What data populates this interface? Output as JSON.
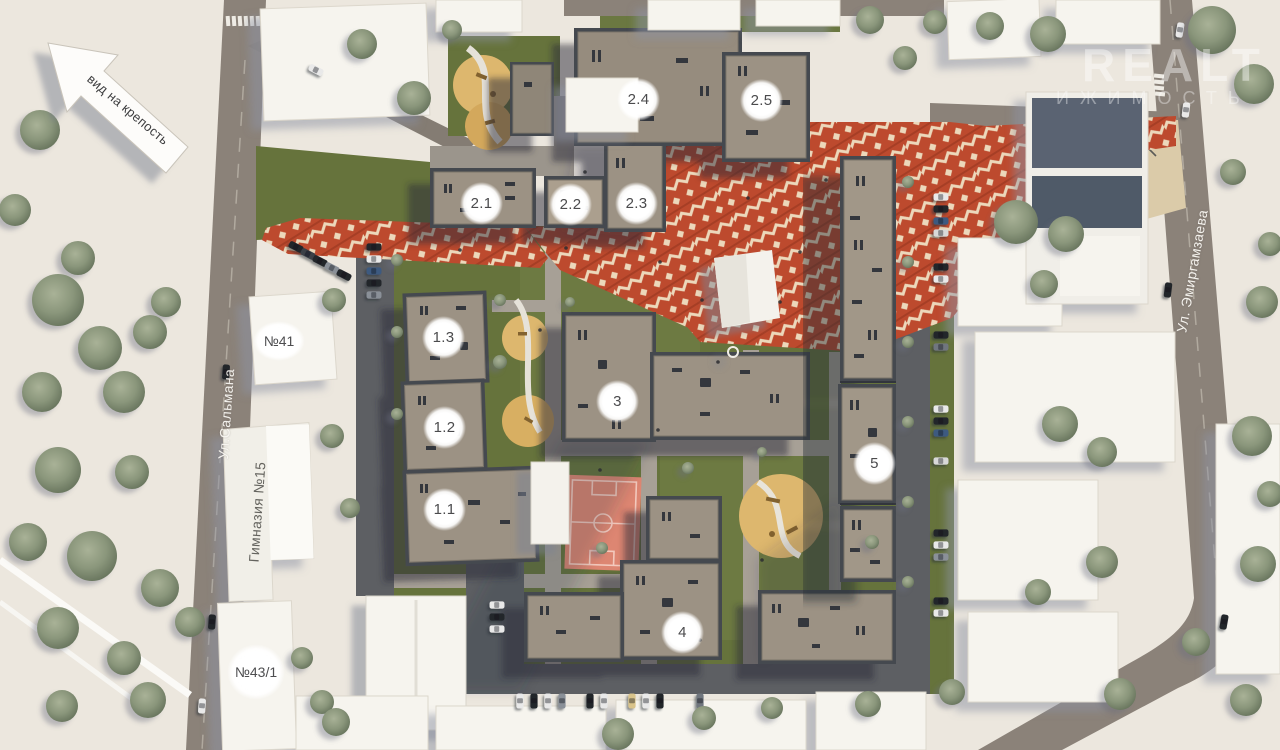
{
  "map": {
    "direction_arrow": {
      "label": "вид на крепость"
    },
    "watermark": {
      "line1": "REALT",
      "line2": "ИЖИМОСТЬ"
    },
    "streets": [
      {
        "id": "salmana",
        "name": "Ул.Сальмана"
      },
      {
        "id": "emirgamzaeva",
        "name": "Ул. Эмиргамзаева"
      }
    ],
    "context_buildings": [
      {
        "id": "n41",
        "label": "№41"
      },
      {
        "id": "gymnasium15",
        "label": "Гимназия №15"
      },
      {
        "id": "n43_1",
        "label": "№43/1"
      }
    ],
    "building_markers": [
      {
        "id": "b2_4",
        "label": "2.4"
      },
      {
        "id": "b2_5",
        "label": "2.5"
      },
      {
        "id": "b2_1",
        "label": "2.1"
      },
      {
        "id": "b2_2",
        "label": "2.2"
      },
      {
        "id": "b2_3",
        "label": "2.3"
      },
      {
        "id": "b1_3",
        "label": "1.3"
      },
      {
        "id": "b1_2",
        "label": "1.2"
      },
      {
        "id": "b1_1",
        "label": "1.1"
      },
      {
        "id": "b3",
        "label": "3"
      },
      {
        "id": "b5",
        "label": "5"
      },
      {
        "id": "b4",
        "label": "4"
      }
    ],
    "colors": {
      "plaza_red": "#bd4a2e",
      "plaza_cream": "#ecd8bb",
      "grass": "#66733c",
      "roof": "#9c9284",
      "road": "#8b8279",
      "sand": "#ddb76e",
      "court_pink": "#dd8672",
      "background": "#ece7de"
    }
  }
}
